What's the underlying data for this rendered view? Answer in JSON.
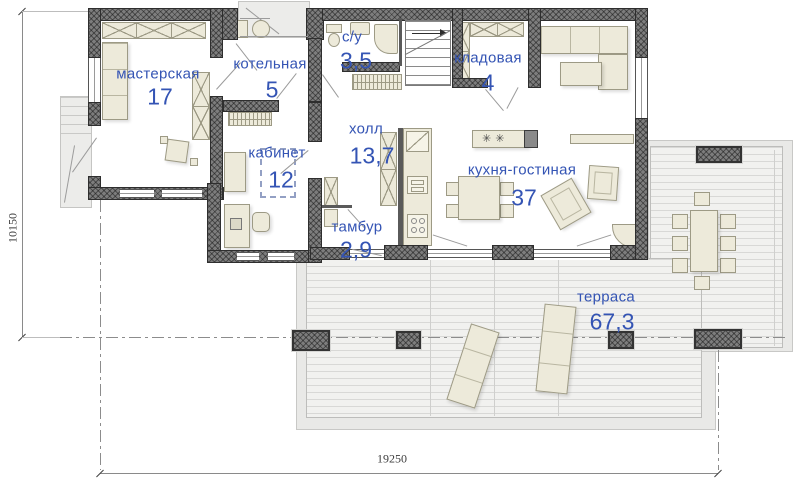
{
  "meta": {
    "type": "floor-plan",
    "language": "ru",
    "view": "first-floor plan with terrace"
  },
  "colors": {
    "label_blue": "#3454b4",
    "wall_fill": "#7d7d7d",
    "wall_edge": "#2e2e2e",
    "furniture_fill": "#edeada",
    "furniture_edge": "#9d9a85",
    "deck_fill": "#f1f1ef",
    "deck_line": "#d8d8d6",
    "dimension_text": "#3c3c3c"
  },
  "rooms": [
    {
      "id": "masterskaya",
      "name": "мастерская",
      "area": "17"
    },
    {
      "id": "kotelnaya",
      "name": "котельная",
      "area": "5"
    },
    {
      "id": "su",
      "name": "с/у",
      "area": "3,5"
    },
    {
      "id": "kladovaya",
      "name": "кладовая",
      "area": "4"
    },
    {
      "id": "holl",
      "name": "холл",
      "area": "13,7"
    },
    {
      "id": "kabinet",
      "name": "кабинет",
      "area": "12"
    },
    {
      "id": "kuhnya",
      "name": "кухня-гостиная",
      "area": "37"
    },
    {
      "id": "tambur",
      "name": "тамбур",
      "area": "2,9"
    },
    {
      "id": "terrasa",
      "name": "терраса",
      "area": "67,3"
    }
  ],
  "dimensions": {
    "bottom": "19250",
    "left": "10150"
  },
  "icons": {
    "burner": "✳"
  }
}
